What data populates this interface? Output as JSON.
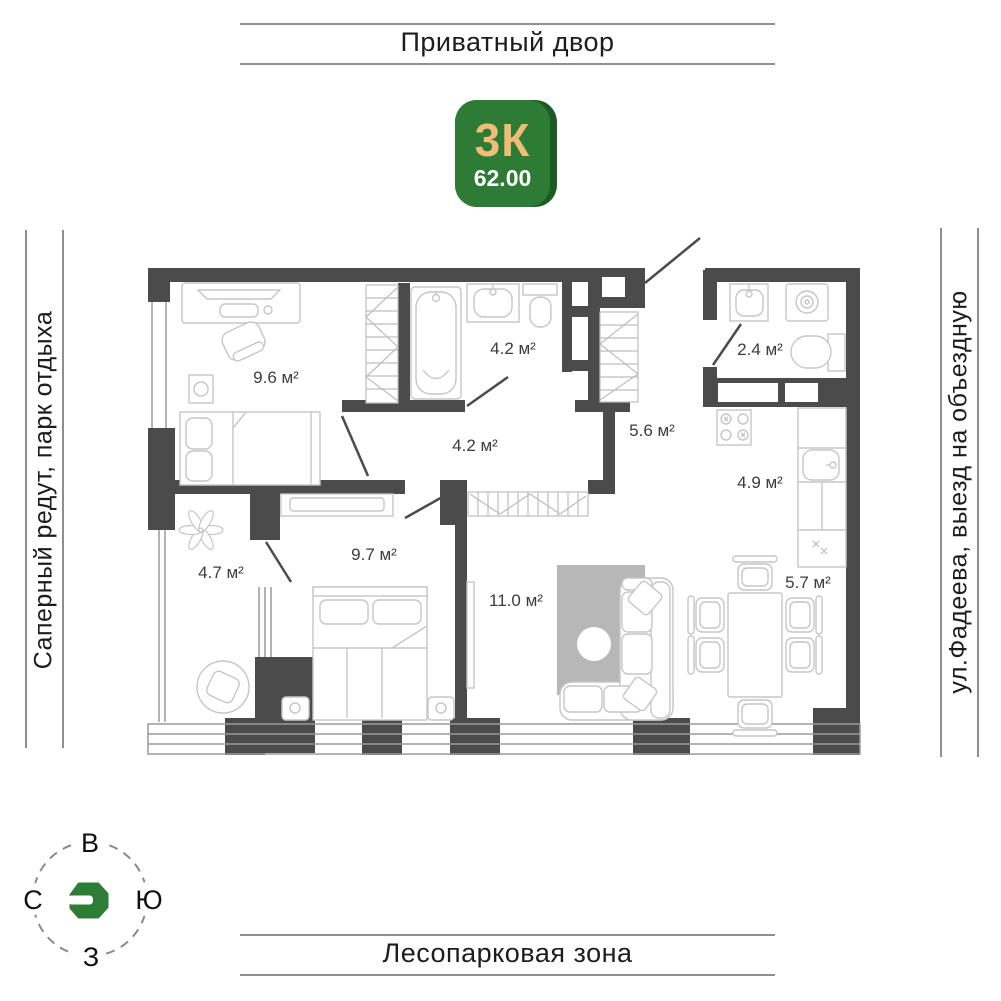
{
  "header": {
    "title": "Приватный двор"
  },
  "footer": {
    "title": "Лесопарковая зона"
  },
  "sides": {
    "left": "Саперный редут, парк отдыха",
    "right": "ул.Фадеева, выезд на объездную"
  },
  "badge": {
    "rooms": "3К",
    "area": "62.00"
  },
  "compass": {
    "top": "В",
    "left": "С",
    "right": "Ю",
    "bottom": "З"
  },
  "plan": {
    "rooms": [
      {
        "id": "bedroom-1",
        "area": "9.6 м²"
      },
      {
        "id": "bathroom",
        "area": "4.2 м²"
      },
      {
        "id": "hallway",
        "area": "4.2 м²"
      },
      {
        "id": "wc",
        "area": "2.4 м²"
      },
      {
        "id": "corridor",
        "area": "5.6 м²"
      },
      {
        "id": "kitchen",
        "area": "4.9 м²"
      },
      {
        "id": "balcony",
        "area": "4.7 м²"
      },
      {
        "id": "bedroom-2",
        "area": "9.7 м²"
      },
      {
        "id": "living-room",
        "area": "11.0 м²"
      },
      {
        "id": "dining",
        "area": "5.7 м²"
      }
    ]
  },
  "colors": {
    "wall": "#4b4b4b",
    "badge_green": "#2e7b36",
    "badge_green_dark": "#1c5a26",
    "badge_accent": "#efbd77",
    "logo_green": "#2e7d36",
    "rug": "#b7b7b7"
  }
}
